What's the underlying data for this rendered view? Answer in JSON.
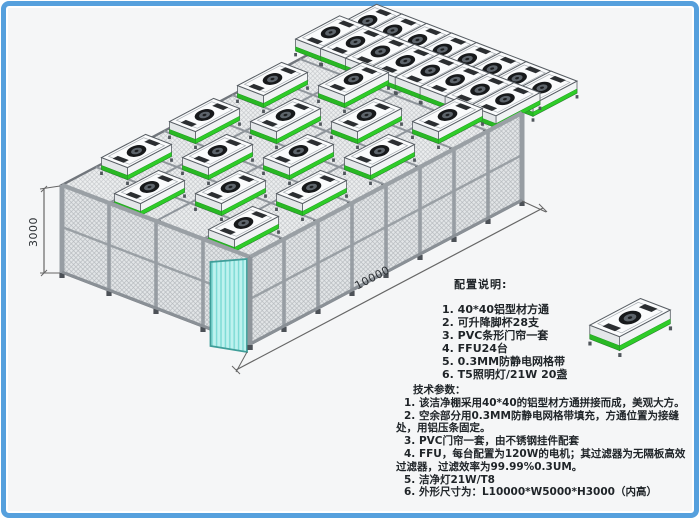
{
  "drawing_title": "洁净棚 (Clean Booth) 轴测图",
  "dimensions": {
    "height_label": "3000",
    "length_label": "10000"
  },
  "config_notes": {
    "title": "配置说明:",
    "items": [
      "1. 40*40铝型材方通",
      "2. 可升降脚杯28支",
      "3. PVC条形门帘一套",
      "4. FFU24台",
      "5. 0.3MM防静电网格带",
      "6. T5照明灯/21W 20盏"
    ]
  },
  "tech_params": {
    "title": "技术参数：",
    "items": [
      "1. 该洁净棚采用40*40的铝型材方通拼接而成，美观大方。",
      "2. 空余部分用0.3MM防静电网格带填充，方通位置为接缝处，用铝压条固定。",
      "3. PVC门帘一套，由不锈钢挂件配套",
      "4. FFU，每台配置为120W的电机；其过滤器为无隔板高效过滤器，过滤效率为99.99%0.3UM。",
      "5. 洁净灯21W/T8",
      "6. 外形尺寸为：L10000*W5000*H3000（内高）"
    ]
  },
  "colors": {
    "border_blue": "#56a0dd",
    "ffu_green": "#2ecc28",
    "door_cyan": "#bef2ef",
    "frame_gray": "#979da3",
    "mesh_gray": "#e3e6e8"
  }
}
